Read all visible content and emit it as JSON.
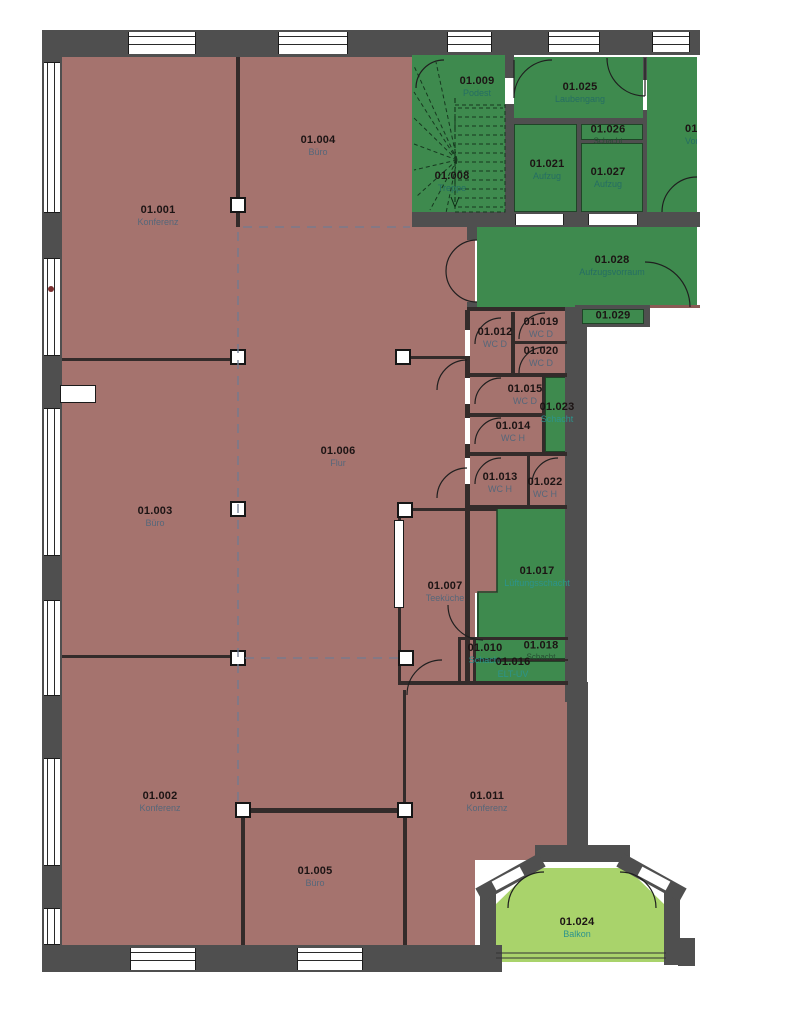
{
  "plan": {
    "type": "architectural-floor-plan",
    "colors": {
      "room_fill_red": "#a5736e",
      "room_fill_green": "#3e8a4e",
      "balcony_fill": "#a9d36b",
      "wall_gray": "#4f4f4f",
      "number_text": "#1c1414",
      "name_text_red_rooms": "#56677a",
      "name_text_green_rooms": "#256e63"
    },
    "rooms": {
      "r001": {
        "number": "01.001",
        "name": "Konferenz"
      },
      "r002": {
        "number": "01.002",
        "name": "Konferenz"
      },
      "r003": {
        "number": "01.003",
        "name": "Büro"
      },
      "r004": {
        "number": "01.004",
        "name": "Büro"
      },
      "r005": {
        "number": "01.005",
        "name": "Büro"
      },
      "r006": {
        "number": "01.006",
        "name": "Flur"
      },
      "r007": {
        "number": "01.007",
        "name": "Teeküche"
      },
      "r008": {
        "number": "01.008",
        "name": "Treppe"
      },
      "r009": {
        "number": "01.009",
        "name": "Podest"
      },
      "r010": {
        "number": "01.010",
        "name": "Schacht"
      },
      "r011": {
        "number": "01.011",
        "name": "Konferenz"
      },
      "r012": {
        "number": "01.012",
        "name": "WC D"
      },
      "r013": {
        "number": "01.013",
        "name": "WC H"
      },
      "r014": {
        "number": "01.014",
        "name": "WC H"
      },
      "r015": {
        "number": "01.015",
        "name": "WC D"
      },
      "r016": {
        "number": "01.016",
        "name": "ELT-UV"
      },
      "r017": {
        "number": "01.017",
        "name": "Lüftungsschacht"
      },
      "r018": {
        "number": "01.018",
        "name": "Schacht"
      },
      "r019": {
        "number": "01.019",
        "name": "WC D"
      },
      "r020": {
        "number": "01.020",
        "name": "WC D"
      },
      "r021": {
        "number": "01.021",
        "name": "Aufzug"
      },
      "r022": {
        "number": "01.022",
        "name": "WC H"
      },
      "r023": {
        "number": "01.023",
        "name": "Schacht"
      },
      "r024": {
        "number": "01.024",
        "name": "Balkon"
      },
      "r025": {
        "number": "01.025",
        "name": "Laubengang"
      },
      "r026": {
        "number": "01.026",
        "name": "Schacht"
      },
      "r027": {
        "number": "01.027",
        "name": "Aufzug"
      },
      "r028": {
        "number": "01.028",
        "name": "Aufzugsvorraum"
      },
      "r029": {
        "number": "01.029",
        "name": ""
      },
      "r030": {
        "number": "01.030",
        "name": "Vorraum"
      }
    }
  }
}
